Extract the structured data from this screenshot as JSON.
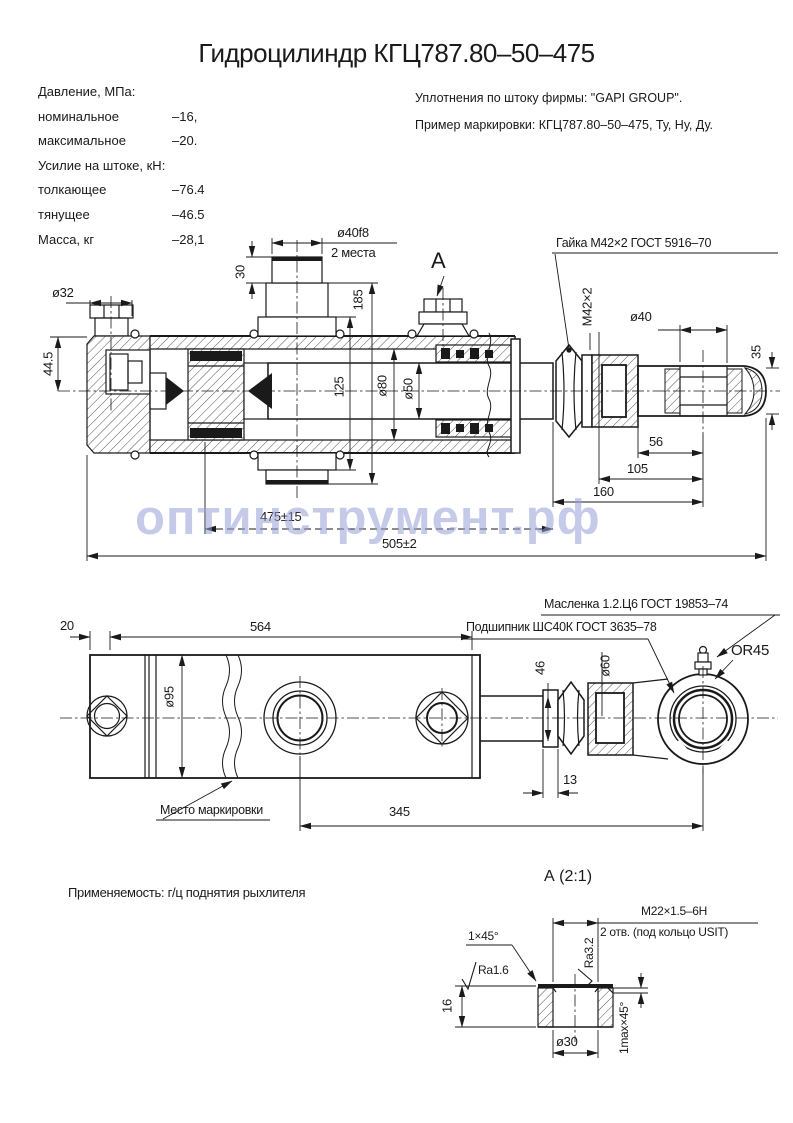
{
  "title": "Гидроцилиндр КГЦ787.80–50–475",
  "specs": {
    "lines": [
      {
        "label": "Давление, МПа:",
        "value": ""
      },
      {
        "label": "номинальное",
        "value": "–16,"
      },
      {
        "label": "максимальное",
        "value": "–20."
      },
      {
        "label": "Усилие на штоке, кН:",
        "value": ""
      },
      {
        "label": "толкающее",
        "value": "–76.4"
      },
      {
        "label": "тянущее",
        "value": "–46.5"
      },
      {
        "label": "Масса, кг",
        "value": "–28,1"
      }
    ]
  },
  "notes": {
    "line1": "Уплотнения по штоку фирмы: \"GAPI GROUP\".",
    "line2": "Пример маркировки: КГЦ787.80–50–475, Ту, Ну, Ду."
  },
  "main_view": {
    "callout_nut": "Гайка М42×2 ГОСТ 5916–70",
    "view_label": "А",
    "dims": {
      "d40f8": "ø40f8",
      "places": "2 места",
      "d30": "30",
      "d185": "185",
      "d32": "ø32",
      "d44_5": "44.5",
      "d125": "125",
      "d80": "ø80",
      "d50": "ø50",
      "m42": "М42×2",
      "d40": "ø40",
      "d35": "35",
      "d56": "56",
      "d105": "105",
      "d160": "160",
      "stroke": "475±15",
      "total": "505±2"
    }
  },
  "watermark": "оптинструмент.рф",
  "side_view": {
    "callout_greaser": "Масленка 1.2.Ц6 ГОСТ 19853–74",
    "callout_bearing": "Подшипник ШС40К ГОСТ 3635–78",
    "marking_label": "Место маркировки",
    "dims": {
      "d20": "20",
      "d564": "564",
      "d95": "ø95",
      "d46": "46",
      "d60": "ø60",
      "r45": "OR45",
      "d13": "13",
      "d345": "345"
    }
  },
  "application": "Применяемость: г/ц поднятия рыхлителя",
  "detail": {
    "view_label": "А (2:1)",
    "thread": "М22×1.5–6Н",
    "thread_note": "2 отв. (под кольцо USIT)",
    "chamfer": "1×45°",
    "ra_top": "Ra3.2",
    "ra_side": "Ra1.6",
    "d16": "16",
    "d30": "ø30",
    "chamfer2": "1max×45°"
  }
}
